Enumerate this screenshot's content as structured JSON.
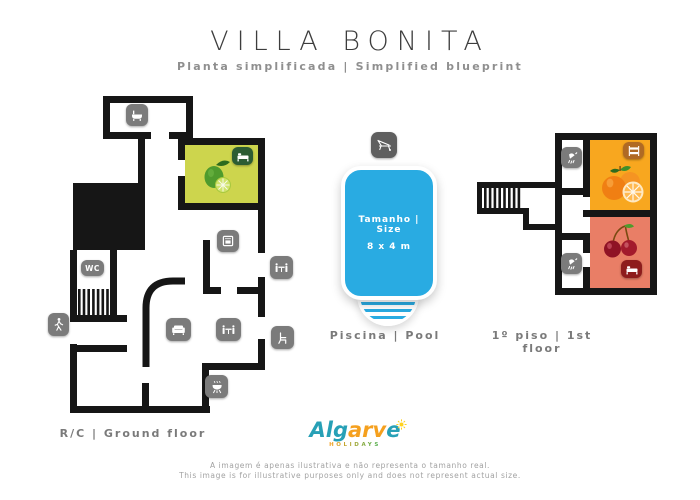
{
  "header": {
    "title": "VILLA BONITA",
    "subtitle": "Planta simplificada | Simplified blueprint"
  },
  "ground_floor": {
    "label": "R/C | Ground floor",
    "wc_text": "WC",
    "bedroom_fill": "#cdd54d",
    "bed_badge_color": "#2c5c33",
    "fruit": "lime",
    "icons": [
      "bathtub-icon",
      "bed-icon",
      "oven-icon",
      "wc-icon",
      "sofa-icon",
      "dining-table-icon",
      "bbq-icon",
      "walking-person-icon",
      "outdoor-dining-table-icon",
      "outdoor-chair-icon"
    ]
  },
  "pool": {
    "label": "Piscina | Pool",
    "size_line1": "Tamanho | Size",
    "size_line2": "8 x 4 m",
    "water_color": "#29abe2",
    "icon": "sun-lounger-icon"
  },
  "first_floor": {
    "label": "1º piso | 1st floor",
    "rooms": [
      {
        "name": "bedroom-orange",
        "fill": "#f8a71f",
        "badge_icon": "bunk-bed-icon",
        "badge_color": "#b06a24",
        "fruit": "oranges"
      },
      {
        "name": "bedroom-red",
        "fill": "#e97e66",
        "badge_icon": "double-bed-icon",
        "badge_color": "#8e1c1c",
        "fruit": "cherries"
      }
    ],
    "bathroom_icons": [
      "shower-icon",
      "shower-icon"
    ]
  },
  "footer": {
    "logo": {
      "segments": [
        {
          "text": "Al",
          "color": "#27a0b6"
        },
        {
          "text": "g",
          "color": "#27a0b6"
        },
        {
          "text": "arv",
          "color": "#f5a01e"
        },
        {
          "text": "e",
          "color": "#27a0b6"
        }
      ],
      "sub": "HOLIDAYS"
    },
    "disclaimer_pt": "A imagem é apenas ilustrativa e não representa o tamanho real.",
    "disclaimer_en": "This image is for illustrative purposes only and does not represent actual size."
  }
}
